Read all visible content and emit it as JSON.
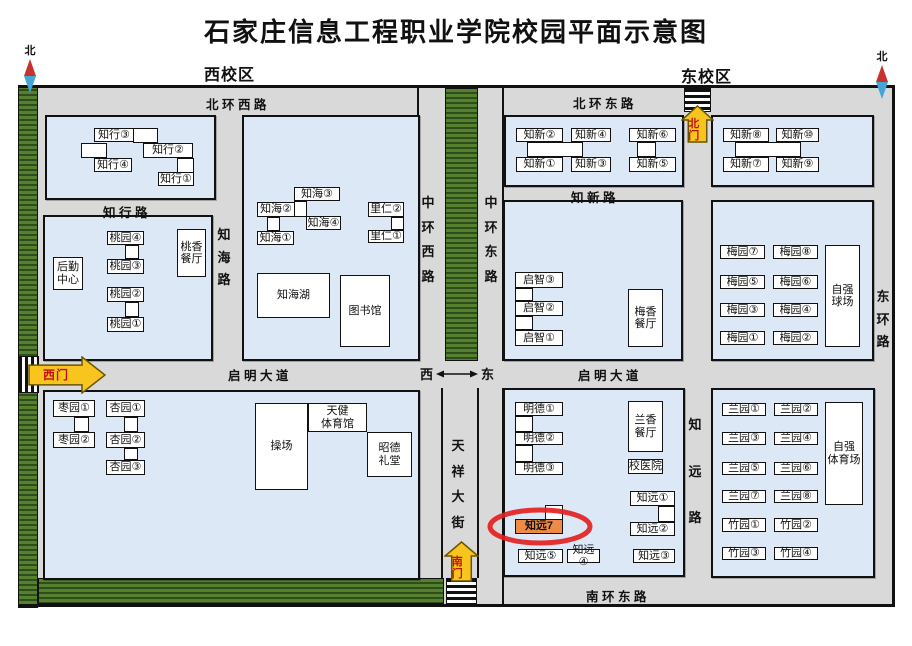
{
  "title": "石家庄信息工程职业学院校园平面示意图",
  "area_labels": [
    {
      "text": "西校区",
      "x": 204,
      "y": 61
    },
    {
      "text": "东校区",
      "x": 681,
      "y": 63
    }
  ],
  "compass": {
    "label": "北",
    "positions": [
      {
        "x": 22,
        "y": 42
      },
      {
        "x": 874,
        "y": 48
      }
    ]
  },
  "direction_indicator": {
    "west": "西",
    "east": "东",
    "x": 420,
    "y": 364
  },
  "colors": {
    "road": "#d9d9d9",
    "block": "#dce8f6",
    "green": "#55812f",
    "green_dark": "#2f4d1c",
    "gate_yellow": "#f7c51e",
    "gate_text": "#c40f0f",
    "highlight_fill": "#ef8b45",
    "highlight_ring": "#e31f1f",
    "compass_red": "#c5342c",
    "compass_blue": "#45a5d6"
  },
  "map": {
    "base": [
      18,
      85,
      877,
      522
    ],
    "greenbelts": [
      [
        18,
        85,
        20,
        523
      ],
      [
        445,
        88,
        33,
        273
      ],
      [
        38,
        578,
        406,
        26
      ]
    ],
    "lines": [
      [
        18,
        85,
        877,
        3
      ],
      [
        18,
        604,
        877,
        3
      ],
      [
        892,
        85,
        3,
        522
      ],
      [
        417,
        85,
        2,
        276
      ],
      [
        502,
        85,
        2,
        276
      ],
      [
        502,
        388,
        2,
        216
      ],
      [
        441,
        388,
        2,
        190
      ],
      [
        477,
        388,
        2,
        190
      ]
    ],
    "zebras": [
      [
        18,
        356,
        21,
        37,
        "v"
      ],
      [
        684,
        88,
        27,
        24,
        "h"
      ],
      [
        446,
        578,
        31,
        26,
        "h"
      ]
    ],
    "blocks": [
      [
        45,
        115,
        171,
        85
      ],
      [
        43,
        215,
        170,
        146
      ],
      [
        242,
        115,
        178,
        246
      ],
      [
        43,
        390,
        377,
        190
      ],
      [
        504,
        115,
        180,
        72
      ],
      [
        711,
        115,
        163,
        72
      ],
      [
        503,
        200,
        180,
        161
      ],
      [
        711,
        200,
        163,
        161
      ],
      [
        503,
        388,
        182,
        189
      ],
      [
        711,
        388,
        164,
        190
      ]
    ]
  },
  "road_labels": {
    "horizontal": [
      {
        "text": "北 环 西 路",
        "x": 206,
        "y": 94
      },
      {
        "text": "北 环 东 路",
        "x": 573,
        "y": 93
      },
      {
        "text": "知 行 路",
        "x": 103,
        "y": 202
      },
      {
        "text": "知 新 路",
        "x": 571,
        "y": 187
      },
      {
        "text": "启 明 大 道",
        "x": 228,
        "y": 365
      },
      {
        "text": "启 明 大 道",
        "x": 578,
        "y": 365
      },
      {
        "text": "南 环 东 路",
        "x": 586,
        "y": 586
      }
    ],
    "vertical": [
      {
        "text": "知海路",
        "x": 217,
        "y": 224,
        "h": 64
      },
      {
        "text": "中环西路",
        "x": 421,
        "y": 192,
        "h": 93
      },
      {
        "text": "中环东路",
        "x": 484,
        "y": 192,
        "h": 93
      },
      {
        "text": "天祥大街",
        "x": 451,
        "y": 435,
        "h": 96
      },
      {
        "text": "知远路",
        "x": 688,
        "y": 414,
        "h": 112
      },
      {
        "text": "东环路",
        "x": 876,
        "y": 286,
        "h": 64
      }
    ]
  },
  "gates": [
    {
      "label": "西门",
      "dir": "right",
      "x": 28,
      "y": 356,
      "w": 78,
      "h": 38
    },
    {
      "label": "北门",
      "dir": "up",
      "x": 681,
      "y": 105,
      "w": 33,
      "h": 38
    },
    {
      "label": "南门",
      "dir": "up",
      "x": 444,
      "y": 541,
      "w": 35,
      "h": 41
    }
  ],
  "highlight_ring": {
    "x": 487,
    "y": 507,
    "w": 106,
    "h": 39
  },
  "connectors": [
    [
      133,
      128,
      25,
      15
    ],
    [
      81,
      143,
      26,
      15
    ],
    [
      177,
      158,
      17,
      15
    ],
    [
      294,
      201,
      13,
      16
    ],
    [
      267,
      217,
      13,
      14
    ],
    [
      391,
      217,
      13,
      13
    ],
    [
      125,
      245,
      14,
      14
    ],
    [
      125,
      302,
      14,
      15
    ],
    [
      74,
      417,
      15,
      15
    ],
    [
      124,
      417,
      14,
      15
    ],
    [
      124,
      448,
      14,
      12
    ],
    [
      527,
      142,
      56,
      15
    ],
    [
      637,
      142,
      19,
      15
    ],
    [
      735,
      142,
      66,
      15
    ],
    [
      515,
      288,
      18,
      13
    ],
    [
      515,
      316,
      18,
      14
    ],
    [
      515,
      416,
      18,
      16
    ],
    [
      515,
      445,
      18,
      17
    ],
    [
      658,
      506,
      17,
      16
    ],
    [
      545,
      505,
      18,
      15
    ]
  ],
  "buildings": [
    {
      "t": "知行③",
      "x": 94,
      "y": 128,
      "w": 40,
      "h": 14
    },
    {
      "t": "知行②",
      "x": 143,
      "y": 143,
      "w": 50,
      "h": 15
    },
    {
      "t": "知行④",
      "x": 94,
      "y": 158,
      "w": 38,
      "h": 14
    },
    {
      "t": "知行①",
      "x": 158,
      "y": 172,
      "w": 36,
      "h": 14
    },
    {
      "t": "知海③",
      "x": 294,
      "y": 187,
      "w": 46,
      "h": 14
    },
    {
      "t": "知海②",
      "x": 257,
      "y": 202,
      "w": 38,
      "h": 15
    },
    {
      "t": "知海④",
      "x": 306,
      "y": 216,
      "w": 35,
      "h": 14
    },
    {
      "t": "知海①",
      "x": 257,
      "y": 231,
      "w": 37,
      "h": 14
    },
    {
      "t": "里仁②",
      "x": 368,
      "y": 202,
      "w": 36,
      "h": 15
    },
    {
      "t": "里仁①",
      "x": 368,
      "y": 230,
      "w": 36,
      "h": 13
    },
    {
      "t": "知海湖",
      "x": 257,
      "y": 273,
      "w": 73,
      "h": 45
    },
    {
      "t": "图书馆",
      "x": 340,
      "y": 275,
      "w": 50,
      "h": 72
    },
    {
      "t": "桃园④",
      "x": 107,
      "y": 231,
      "w": 37,
      "h": 14
    },
    {
      "t": "桃园③",
      "x": 107,
      "y": 259,
      "w": 37,
      "h": 15
    },
    {
      "t": "后勤\n中心",
      "x": 53,
      "y": 257,
      "w": 30,
      "h": 33
    },
    {
      "t": "桃园②",
      "x": 107,
      "y": 287,
      "w": 37,
      "h": 15
    },
    {
      "t": "桃园①",
      "x": 107,
      "y": 317,
      "w": 37,
      "h": 15
    },
    {
      "t": "桃香\n餐厅",
      "x": 177,
      "y": 229,
      "w": 29,
      "h": 48
    },
    {
      "t": "枣园①",
      "x": 53,
      "y": 400,
      "w": 42,
      "h": 17
    },
    {
      "t": "枣园②",
      "x": 53,
      "y": 432,
      "w": 42,
      "h": 16
    },
    {
      "t": "杏园①",
      "x": 106,
      "y": 400,
      "w": 39,
      "h": 17
    },
    {
      "t": "杏园②",
      "x": 106,
      "y": 432,
      "w": 39,
      "h": 16
    },
    {
      "t": "杏园③",
      "x": 106,
      "y": 460,
      "w": 39,
      "h": 15
    },
    {
      "t": "操场",
      "x": 255,
      "y": 403,
      "w": 53,
      "h": 87
    },
    {
      "t": "天健\n体育馆",
      "x": 308,
      "y": 403,
      "w": 59,
      "h": 29
    },
    {
      "t": "昭德\n礼堂",
      "x": 367,
      "y": 432,
      "w": 45,
      "h": 45
    },
    {
      "t": "知新②",
      "x": 516,
      "y": 128,
      "w": 47,
      "h": 14
    },
    {
      "t": "知新④",
      "x": 571,
      "y": 128,
      "w": 40,
      "h": 14
    },
    {
      "t": "知新⑥",
      "x": 629,
      "y": 128,
      "w": 47,
      "h": 14
    },
    {
      "t": "知新①",
      "x": 516,
      "y": 157,
      "w": 47,
      "h": 15
    },
    {
      "t": "知新③",
      "x": 571,
      "y": 157,
      "w": 40,
      "h": 15
    },
    {
      "t": "知新⑤",
      "x": 629,
      "y": 157,
      "w": 47,
      "h": 15
    },
    {
      "t": "知新⑧",
      "x": 723,
      "y": 128,
      "w": 46,
      "h": 14
    },
    {
      "t": "知新⑩",
      "x": 776,
      "y": 128,
      "w": 43,
      "h": 14
    },
    {
      "t": "知新⑦",
      "x": 723,
      "y": 157,
      "w": 46,
      "h": 15
    },
    {
      "t": "知新⑨",
      "x": 776,
      "y": 157,
      "w": 43,
      "h": 15
    },
    {
      "t": "启智③",
      "x": 515,
      "y": 272,
      "w": 48,
      "h": 16
    },
    {
      "t": "启智②",
      "x": 515,
      "y": 301,
      "w": 48,
      "h": 15
    },
    {
      "t": "启智①",
      "x": 515,
      "y": 330,
      "w": 48,
      "h": 16
    },
    {
      "t": "梅香\n餐厅",
      "x": 628,
      "y": 289,
      "w": 35,
      "h": 58
    },
    {
      "t": "梅园⑦",
      "x": 720,
      "y": 245,
      "w": 45,
      "h": 14
    },
    {
      "t": "梅园⑧",
      "x": 773,
      "y": 245,
      "w": 45,
      "h": 14
    },
    {
      "t": "梅园⑤",
      "x": 720,
      "y": 275,
      "w": 45,
      "h": 14
    },
    {
      "t": "梅园⑥",
      "x": 773,
      "y": 275,
      "w": 45,
      "h": 14
    },
    {
      "t": "梅园③",
      "x": 720,
      "y": 303,
      "w": 45,
      "h": 14
    },
    {
      "t": "梅园④",
      "x": 773,
      "y": 303,
      "w": 45,
      "h": 14
    },
    {
      "t": "梅园①",
      "x": 720,
      "y": 331,
      "w": 45,
      "h": 14
    },
    {
      "t": "梅园②",
      "x": 773,
      "y": 331,
      "w": 45,
      "h": 14
    },
    {
      "t": "自强\n球场",
      "x": 825,
      "y": 245,
      "w": 35,
      "h": 102
    },
    {
      "t": "明德①",
      "x": 515,
      "y": 402,
      "w": 48,
      "h": 14
    },
    {
      "t": "明德②",
      "x": 515,
      "y": 432,
      "w": 48,
      "h": 13
    },
    {
      "t": "明德③",
      "x": 515,
      "y": 462,
      "w": 48,
      "h": 13
    },
    {
      "t": "兰香\n餐厅",
      "x": 628,
      "y": 401,
      "w": 35,
      "h": 51
    },
    {
      "t": "校医院",
      "x": 628,
      "y": 459,
      "w": 35,
      "h": 15
    },
    {
      "t": "知远①",
      "x": 630,
      "y": 491,
      "w": 45,
      "h": 15
    },
    {
      "t": "知远②",
      "x": 630,
      "y": 522,
      "w": 45,
      "h": 14
    },
    {
      "t": "知远③",
      "x": 633,
      "y": 549,
      "w": 42,
      "h": 14
    },
    {
      "t": "知远④",
      "x": 567,
      "y": 549,
      "w": 33,
      "h": 14
    },
    {
      "t": "知远⑤",
      "x": 518,
      "y": 549,
      "w": 45,
      "h": 14
    },
    {
      "t": "知远7",
      "x": 515,
      "y": 519,
      "w": 48,
      "h": 15,
      "hl": true
    },
    {
      "t": "兰园①",
      "x": 722,
      "y": 403,
      "w": 44,
      "h": 13
    },
    {
      "t": "兰园②",
      "x": 774,
      "y": 403,
      "w": 44,
      "h": 13
    },
    {
      "t": "兰园③",
      "x": 722,
      "y": 432,
      "w": 44,
      "h": 13
    },
    {
      "t": "兰园④",
      "x": 774,
      "y": 432,
      "w": 44,
      "h": 13
    },
    {
      "t": "兰园⑤",
      "x": 722,
      "y": 462,
      "w": 44,
      "h": 13
    },
    {
      "t": "兰园⑥",
      "x": 774,
      "y": 462,
      "w": 44,
      "h": 13
    },
    {
      "t": "兰园⑦",
      "x": 722,
      "y": 490,
      "w": 44,
      "h": 13
    },
    {
      "t": "兰园⑧",
      "x": 774,
      "y": 490,
      "w": 44,
      "h": 13
    },
    {
      "t": "竹园①",
      "x": 722,
      "y": 518,
      "w": 44,
      "h": 14
    },
    {
      "t": "竹园②",
      "x": 774,
      "y": 518,
      "w": 44,
      "h": 14
    },
    {
      "t": "竹园③",
      "x": 722,
      "y": 547,
      "w": 44,
      "h": 13
    },
    {
      "t": "竹园④",
      "x": 774,
      "y": 547,
      "w": 44,
      "h": 13
    },
    {
      "t": "自强\n体育场",
      "x": 825,
      "y": 402,
      "w": 38,
      "h": 103
    }
  ]
}
